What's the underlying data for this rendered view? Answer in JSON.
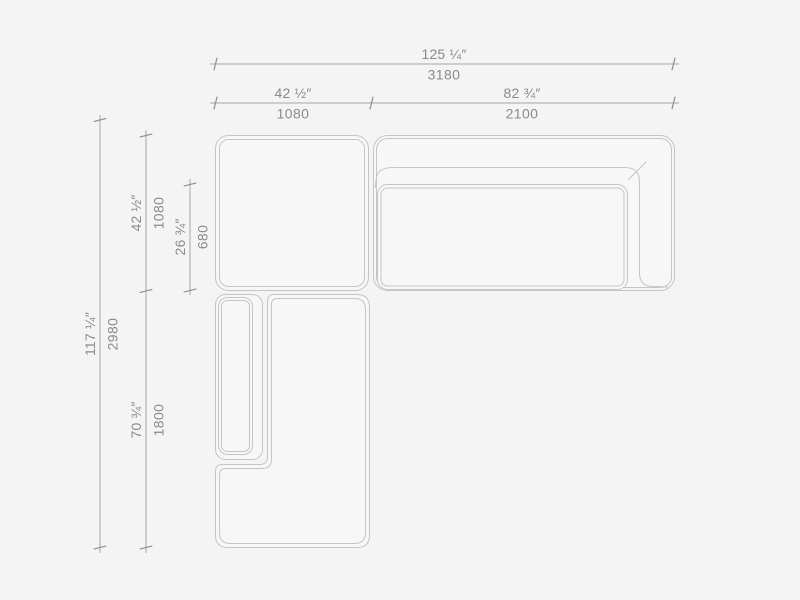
{
  "page": {
    "type": "sofa-dimension-drawing",
    "view": "top",
    "background": "#f4f4f4"
  },
  "colors": {
    "outline": "#c5c5c5",
    "dimension_line": "#a6a6a6",
    "tick": "#8f8f8f",
    "text": "#8a8a8a"
  },
  "dimensions": {
    "total_width": {
      "inches": "125 ¼″",
      "mm": "3180"
    },
    "left_section_width": {
      "inches": "42 ½″",
      "mm": "1080"
    },
    "right_section_width": {
      "inches": "82 ¾″",
      "mm": "2100"
    },
    "total_depth": {
      "inches": "117 ¼″",
      "mm": "2980"
    },
    "top_section_depth": {
      "inches": "42 ½″",
      "mm": "1080"
    },
    "seat_depth": {
      "inches": "26 ¾″",
      "mm": "680"
    },
    "chaise_section_length": {
      "inches": "70 ¾″",
      "mm": "1800"
    }
  }
}
